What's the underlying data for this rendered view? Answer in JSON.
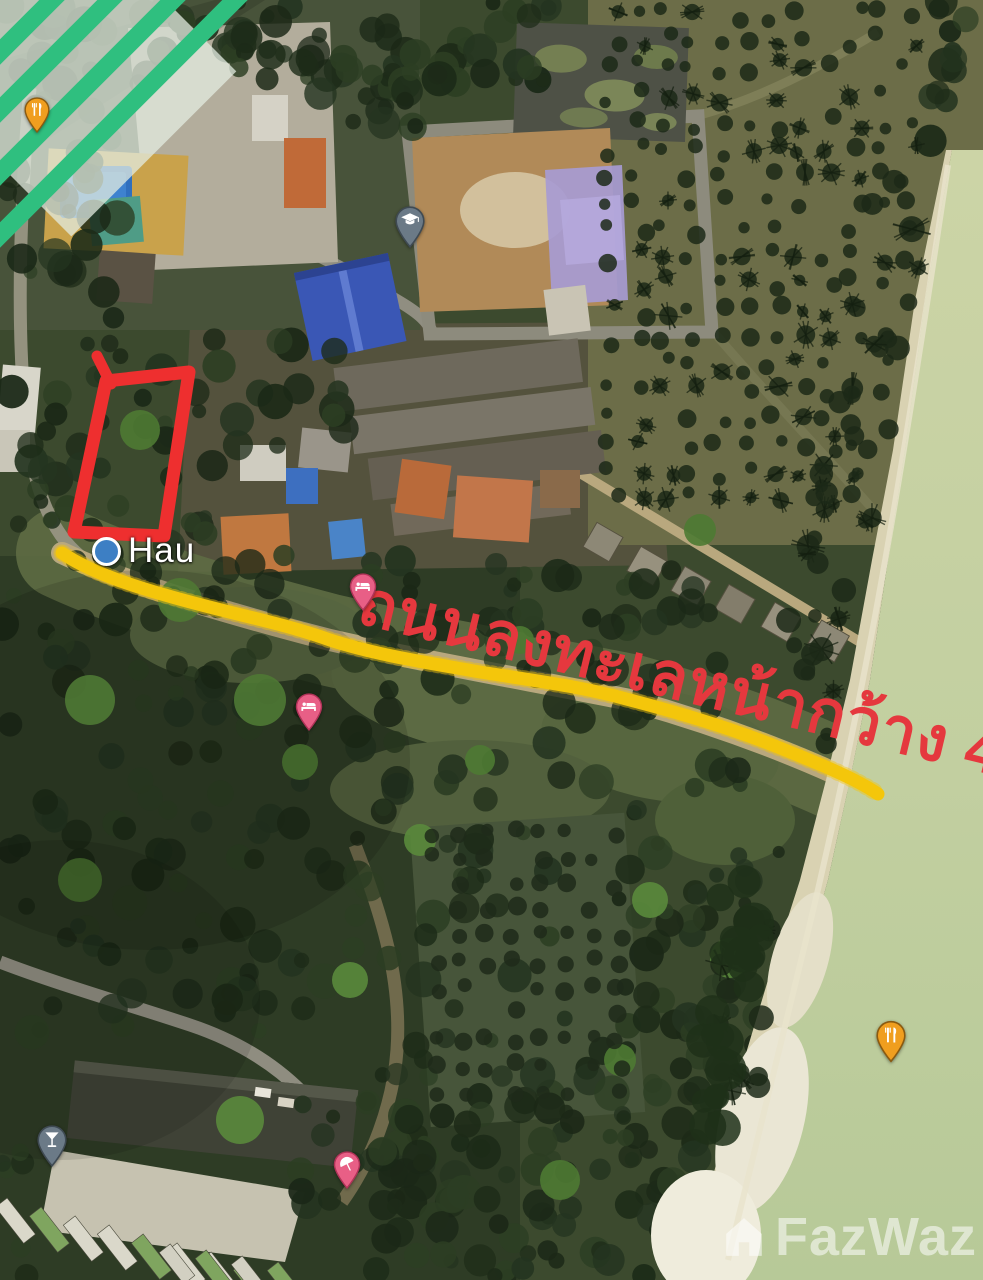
{
  "map": {
    "view": "satellite",
    "place_label": {
      "text": "Hau"
    },
    "annotations": {
      "road_text": "ถนนลงทะเลหน้ากว้าง 4 เม",
      "road_text_color": "#e5383e",
      "plot_outline_color": "#ee2f2f",
      "road_highlight_color": "#f4c60b"
    },
    "pins": [
      {
        "name": "restaurant-pin-1",
        "type": "restaurant",
        "icon": "fork-knife-icon",
        "fill": "#f09e1f",
        "border": "#8a5a10",
        "x": 37,
        "y": 138,
        "w": 26,
        "h": 36
      },
      {
        "name": "school-pin",
        "type": "school",
        "icon": "graduation-cap-icon",
        "fill": "#6b7a87",
        "border": "#3f4a53",
        "x": 410,
        "y": 253,
        "w": 30,
        "h": 42
      },
      {
        "name": "hotel-pin-1",
        "type": "lodging",
        "icon": "bed-icon",
        "fill": "#e85f86",
        "border": "#b03358",
        "x": 363,
        "y": 616,
        "w": 28,
        "h": 38
      },
      {
        "name": "hotel-pin-2",
        "type": "lodging",
        "icon": "bed-icon",
        "fill": "#e85f86",
        "border": "#b03358",
        "x": 309,
        "y": 736,
        "w": 28,
        "h": 38
      },
      {
        "name": "beach-pin",
        "type": "beach",
        "icon": "umbrella-icon",
        "fill": "#e85f86",
        "border": "#b03358",
        "x": 347,
        "y": 1194,
        "w": 28,
        "h": 38
      },
      {
        "name": "restaurant-pin-2",
        "type": "restaurant",
        "icon": "fork-knife-icon",
        "fill": "#f09e1f",
        "border": "#8a5a10",
        "x": 891,
        "y": 1068,
        "w": 30,
        "h": 43
      },
      {
        "name": "bar-pin",
        "type": "bar",
        "icon": "cocktail-icon",
        "fill": "#6b7a87",
        "border": "#3f4a53",
        "x": 52,
        "y": 1172,
        "w": 30,
        "h": 42
      }
    ],
    "watermark": {
      "text": "FazWaz"
    }
  }
}
